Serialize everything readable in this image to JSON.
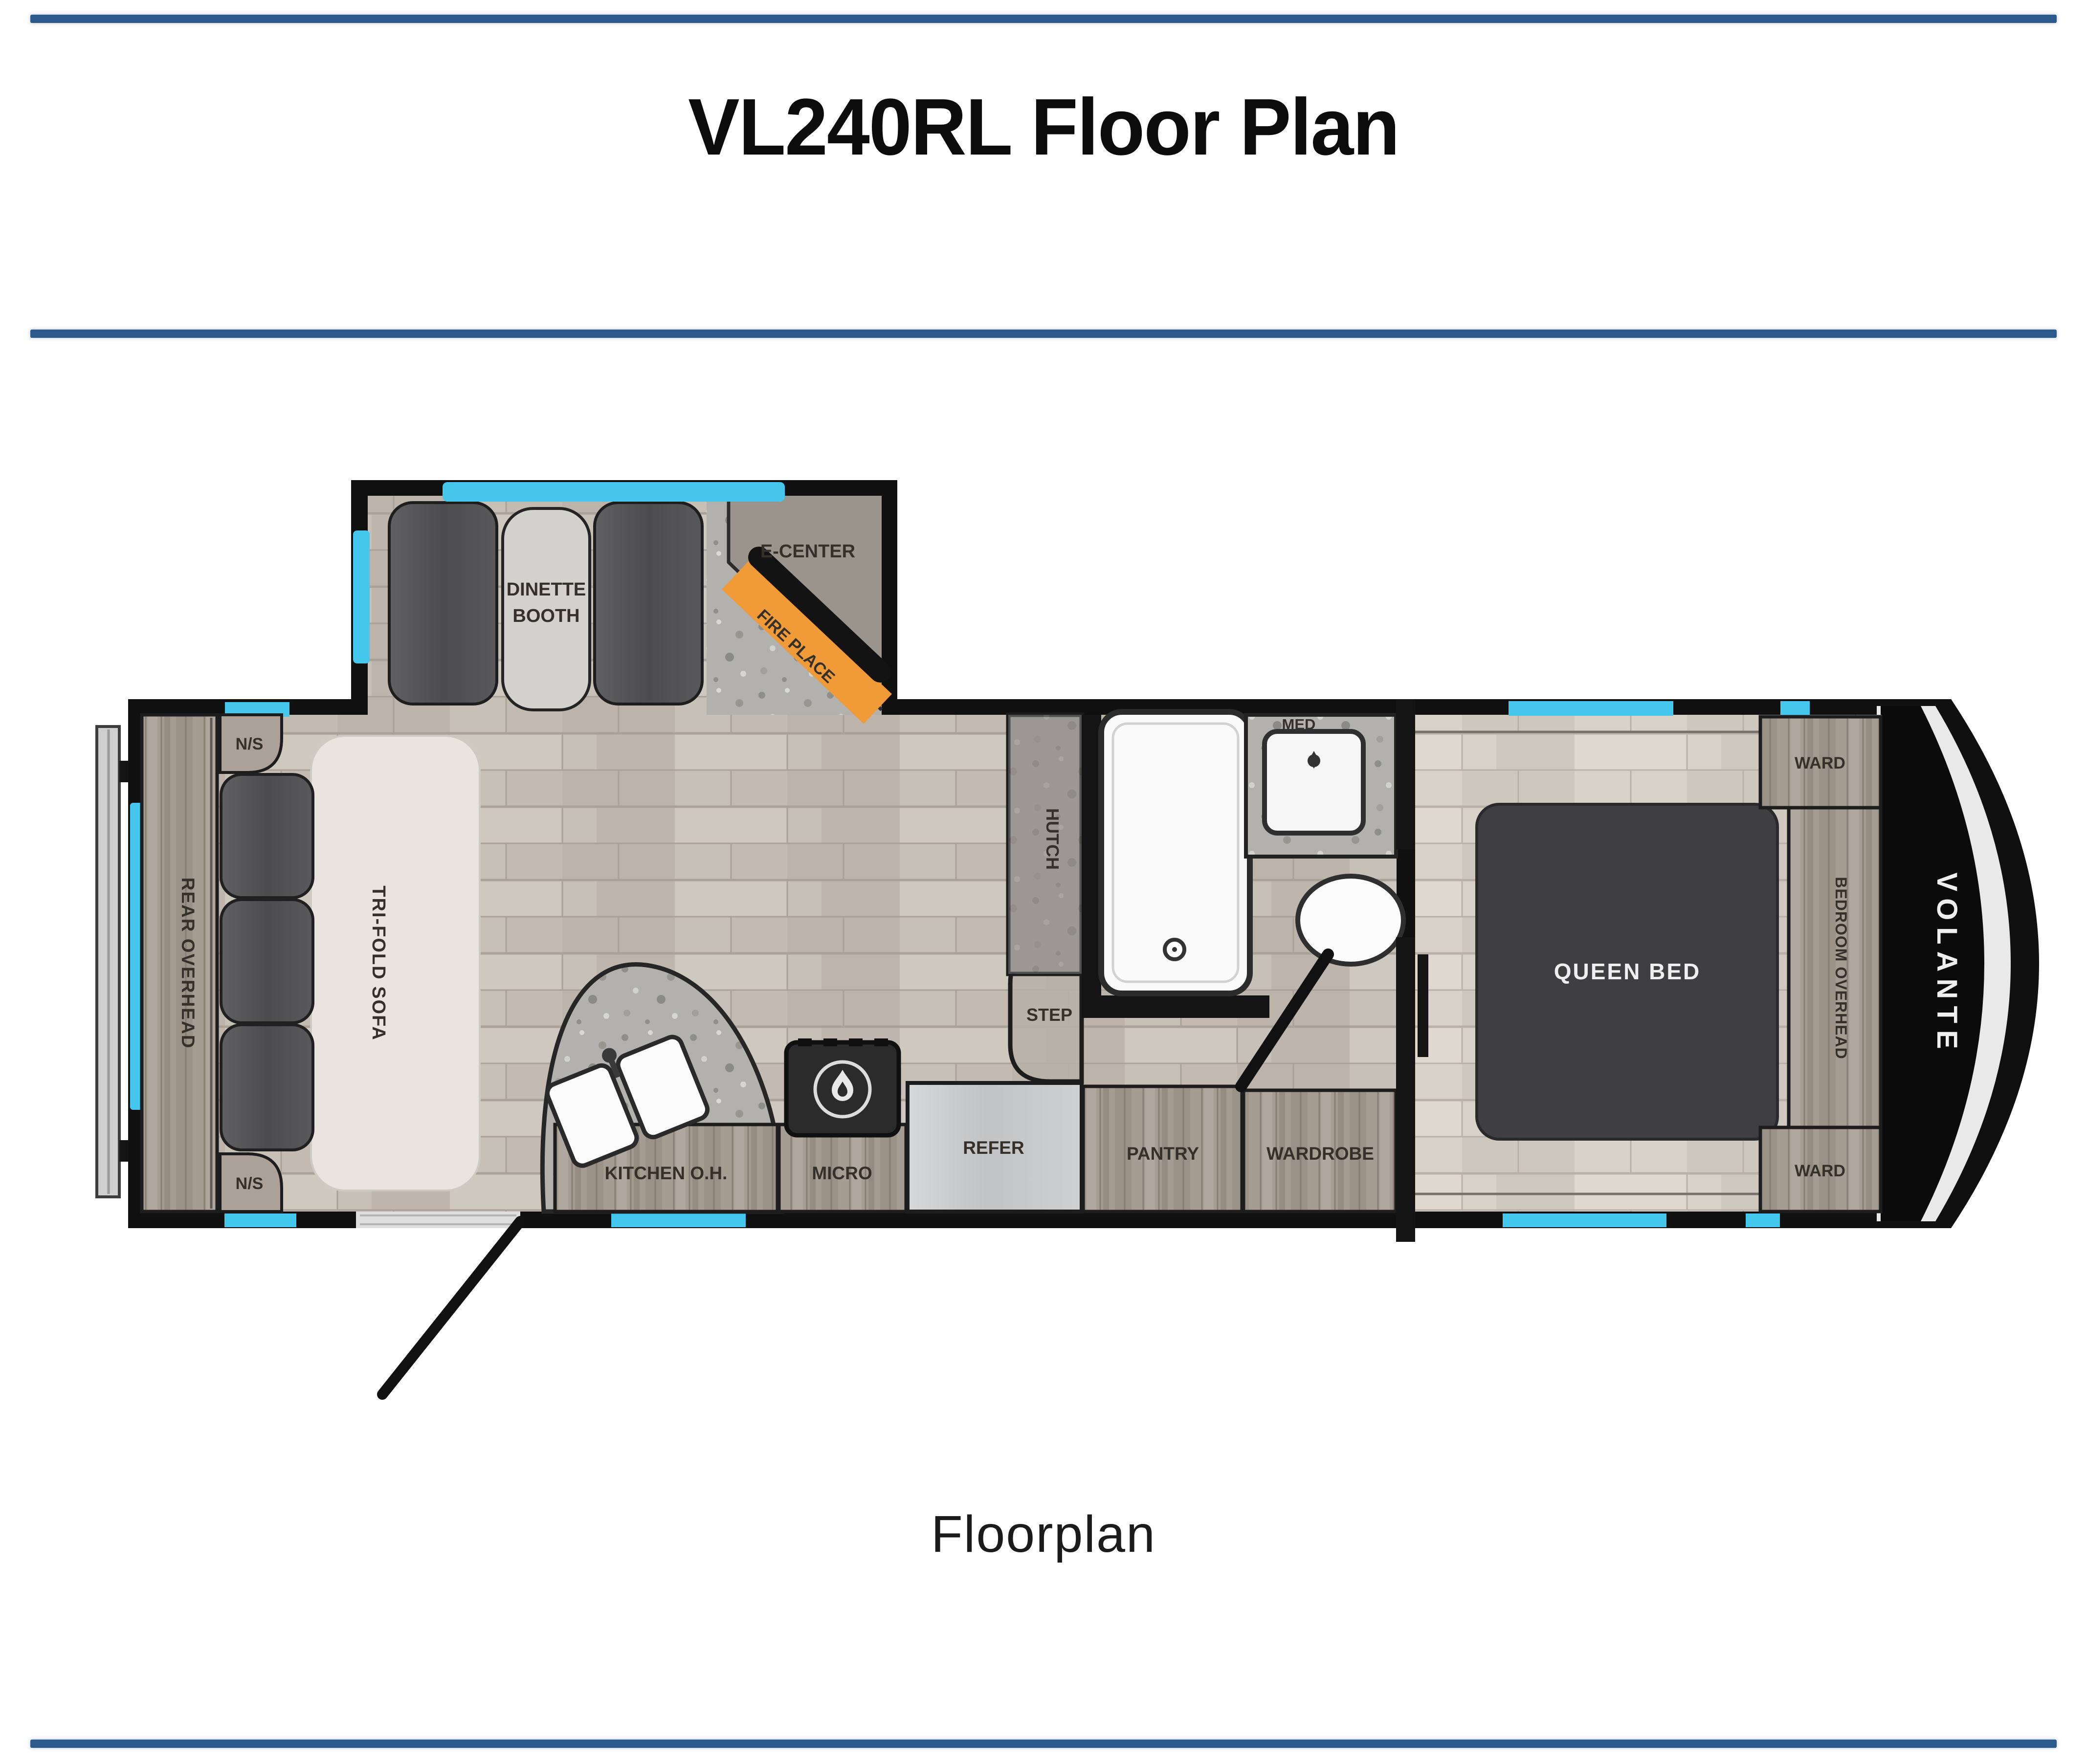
{
  "header": {
    "title": "VL240RL Floor Plan"
  },
  "footer": {
    "caption": "Floorplan"
  },
  "colors": {
    "rule": "#2d5a8c",
    "window": "#45c6ec",
    "fireplace": "#f09a38",
    "bed": "#3f3f42",
    "wall": "#141414"
  },
  "floorplan": {
    "brand": "VOLANTE",
    "labels": {
      "dinette_line1": "DINETTE",
      "dinette_line2": "BOOTH",
      "e_center": "E-CENTER",
      "fire_place": "FIRE PLACE",
      "ns": "N/S",
      "rear_overhead": "REAR OVERHEAD",
      "tri_fold_sofa": "TRI-FOLD SOFA",
      "hutch": "HUTCH",
      "med": "MED",
      "step": "STEP",
      "kitchen_oh": "KITCHEN O.H.",
      "micro": "MICRO",
      "refer": "REFER",
      "pantry": "PANTRY",
      "wardrobe": "WARDROBE",
      "queen_bed": "QUEEN BED",
      "ward": "WARD",
      "bedroom_overhead": "BEDROOM OVERHEAD"
    }
  }
}
